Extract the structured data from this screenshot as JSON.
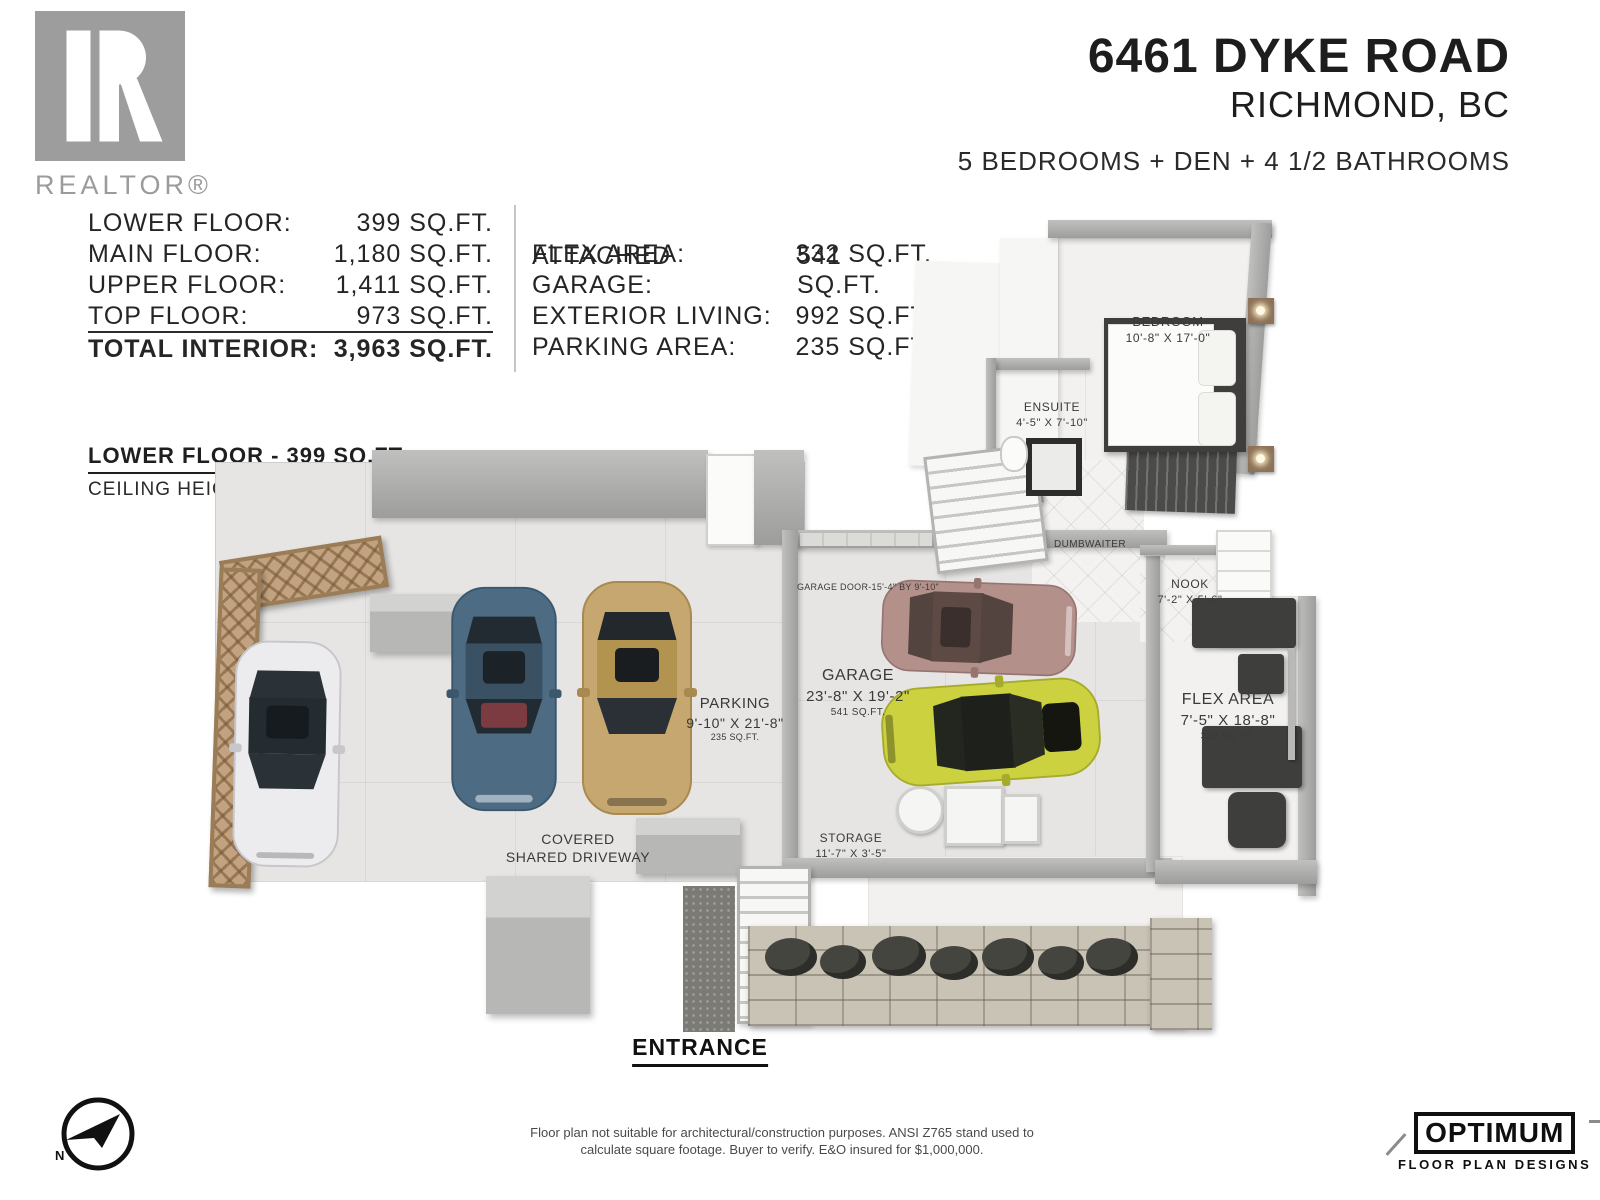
{
  "header": {
    "realtor": "REALTOR®",
    "address": "6461 DYKE ROAD",
    "city": "RICHMOND, BC",
    "specs": "5 BEDROOMS + DEN + 4 1/2 BATHROOMS"
  },
  "stats": {
    "left": [
      {
        "label": "LOWER FLOOR:",
        "value": "399 SQ.FT."
      },
      {
        "label": "MAIN FLOOR:",
        "value": "1,180 SQ.FT."
      },
      {
        "label": "UPPER FLOOR:",
        "value": "1,411 SQ.FT."
      },
      {
        "label": "TOP FLOOR:",
        "value": "973 SQ.FT."
      },
      {
        "label": "TOTAL INTERIOR:",
        "value": "3,963 SQ.FT."
      }
    ],
    "right": [
      {
        "label": "FLEX AREA:",
        "value": "332 SQ.FT."
      },
      {
        "label": "ATTACHED GARAGE:",
        "value": "541 SQ.FT."
      },
      {
        "label": "EXTERIOR LIVING:",
        "value": "992 SQ.FT."
      },
      {
        "label": "PARKING AREA:",
        "value": "235 SQ.FT."
      }
    ]
  },
  "floor_section": {
    "title": "LOWER FLOOR - 399 SQ.FT.",
    "ceiling": "CEILING HEIGHT: 7'-9\""
  },
  "rooms": {
    "bedroom": {
      "name": "BEDROOM",
      "dims": "10'-8\" X 17'-0\""
    },
    "ensuite": {
      "name": "ENSUITE",
      "dims": "4'-5\" X 7'-10\""
    },
    "dumbwaiter": {
      "name": "DUMBWAITER"
    },
    "nook": {
      "name": "NOOK",
      "dims": "7'-2\" X 5'-6\""
    },
    "flex_area": {
      "name": "FLEX AREA",
      "dims": "7'-5\" X 18'-8\"",
      "area": "332 SQ.FT."
    },
    "garage": {
      "name": "GARAGE",
      "dims": "23'-8\" X 19'-2\"",
      "area": "541 SQ.FT."
    },
    "garage_door": {
      "label": "GARAGE DOOR-15'-4\" BY 9'-10\""
    },
    "parking": {
      "name": "PARKING",
      "dims": "9'-10\" X 21'-8\"",
      "area": "235 SQ.FT."
    },
    "storage": {
      "name": "STORAGE",
      "dims": "11'-7\" X 3'-5\""
    },
    "driveway": {
      "line1": "COVERED",
      "line2": "SHARED DRIVEWAY"
    },
    "entrance": "ENTRANCE"
  },
  "footer": {
    "disclaimer1": "Floor plan not suitable for architectural/construction purposes. ANSI Z765 stand used to",
    "disclaimer2": "calculate square footage. Buyer to verify.  E&O insured for $1,000,000.",
    "compass_n": "N",
    "brand_name": "OPTIMUM",
    "brand_tagline": "FLOOR PLAN DESIGNS"
  },
  "colors": {
    "car_white": "#ececee",
    "car_blue": "#4d6c83",
    "car_gold": "#c6a76f",
    "car_rose": "#b3908a",
    "car_yellow": "#ccd23f",
    "wall_gray": "#a6a6a5",
    "wood_trellis": "#c2a381"
  }
}
